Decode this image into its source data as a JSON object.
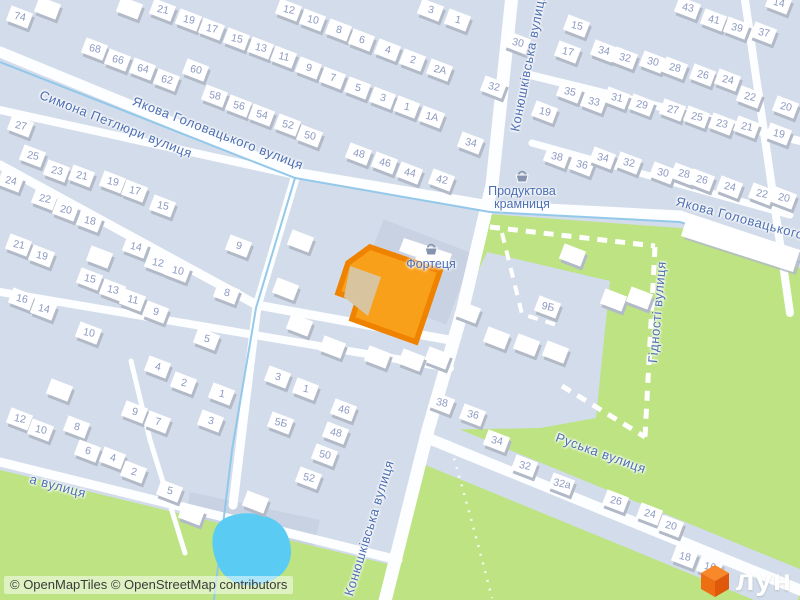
{
  "map": {
    "attribution": "© OpenMapTiles © OpenStreetMap contributors",
    "logo": {
      "text": "лун"
    },
    "colors": {
      "base": "#D3DCEA",
      "road": "#FDFEFF",
      "green": "#BDE383",
      "water": "#5ACBF3",
      "water_line": "#8EC6E9",
      "parcel": "#C9D2E2",
      "building": "#FFFFFF",
      "building_shadow": "#B2B9C7",
      "number": "#8C99C2",
      "label": "#4C6FB3",
      "selected_fill": "#F9A01B",
      "selected_stroke": "#EF8300",
      "selected_inner": "#D8C5A0",
      "logo_orange": "#F4700E",
      "attribution_text": "#3B3B3B"
    },
    "street_labels": [
      {
        "text": "Симона Петлюри вулиця",
        "x": 116,
        "y": 124,
        "rot": 21.5
      },
      {
        "text": "Якова Головацького вулиця",
        "x": 218,
        "y": 133,
        "rot": 21
      },
      {
        "text": "Якова Головацького",
        "x": 740,
        "y": 218,
        "rot": 15
      },
      {
        "text": "Конюшківська вулиця",
        "x": 528,
        "y": 62,
        "rot": -79
      },
      {
        "text": "Конюшківська вулиця",
        "x": 369,
        "y": 528,
        "rot": -73
      },
      {
        "text": "Руська вулиця",
        "x": 601,
        "y": 453,
        "rot": 20
      },
      {
        "text": "Гідності вулиця",
        "x": 657,
        "y": 312,
        "rot": -85
      },
      {
        "text": "а вулиця",
        "x": 58,
        "y": 486,
        "rot": 15
      }
    ],
    "pois": [
      {
        "lines": [
          "Продуктова",
          "крамниця"
        ],
        "x": 522,
        "y": 178,
        "icon": "shop-basket-icon"
      },
      {
        "lines": [
          "Фортеця"
        ],
        "x": 431,
        "y": 251,
        "icon": "shop-basket-icon"
      }
    ],
    "house_numbers": [
      [
        20,
        17,
        "74"
      ],
      [
        95,
        49,
        "68"
      ],
      [
        118,
        60,
        "66"
      ],
      [
        143,
        69,
        "64"
      ],
      [
        167,
        80,
        "62"
      ],
      [
        196,
        70,
        "60"
      ],
      [
        215,
        96,
        "58"
      ],
      [
        239,
        106,
        "56"
      ],
      [
        262,
        115,
        "54"
      ],
      [
        163,
        10,
        "21"
      ],
      [
        189,
        20,
        "19"
      ],
      [
        212,
        29,
        "17"
      ],
      [
        237,
        39,
        "15"
      ],
      [
        261,
        48,
        "13"
      ],
      [
        289,
        10,
        "12"
      ],
      [
        313,
        20,
        "10"
      ],
      [
        339,
        30,
        "8"
      ],
      [
        362,
        40,
        "6"
      ],
      [
        388,
        50,
        "4"
      ],
      [
        413,
        60,
        "2"
      ],
      [
        440,
        70,
        "2А"
      ],
      [
        431,
        10,
        "3"
      ],
      [
        458,
        20,
        "1"
      ],
      [
        518,
        43,
        "30"
      ],
      [
        494,
        87,
        "32"
      ],
      [
        284,
        57,
        "11"
      ],
      [
        309,
        68,
        "9"
      ],
      [
        333,
        78,
        "7"
      ],
      [
        358,
        88,
        "5"
      ],
      [
        383,
        98,
        "3"
      ],
      [
        407,
        107,
        "1"
      ],
      [
        432,
        117,
        "1А"
      ],
      [
        288,
        125,
        "52"
      ],
      [
        310,
        136,
        "50"
      ],
      [
        359,
        154,
        "48"
      ],
      [
        385,
        163,
        "46"
      ],
      [
        410,
        173,
        "44"
      ],
      [
        442,
        180,
        "42"
      ],
      [
        471,
        143,
        "34"
      ],
      [
        21,
        126,
        "27"
      ],
      [
        33,
        156,
        "25"
      ],
      [
        57,
        171,
        "23"
      ],
      [
        82,
        176,
        "21"
      ],
      [
        113,
        182,
        "19"
      ],
      [
        135,
        191,
        "17"
      ],
      [
        163,
        206,
        "15"
      ],
      [
        11,
        181,
        "24"
      ],
      [
        45,
        199,
        "22"
      ],
      [
        66,
        210,
        "20"
      ],
      [
        90,
        221,
        "18"
      ],
      [
        136,
        247,
        "14"
      ],
      [
        158,
        263,
        "12"
      ],
      [
        178,
        271,
        "10"
      ],
      [
        239,
        246,
        "9"
      ],
      [
        19,
        245,
        "21"
      ],
      [
        42,
        256,
        "19"
      ],
      [
        90,
        279,
        "15"
      ],
      [
        113,
        290,
        "13"
      ],
      [
        133,
        300,
        "11"
      ],
      [
        156,
        312,
        "9"
      ],
      [
        22,
        299,
        "16"
      ],
      [
        44,
        309,
        "14"
      ],
      [
        89,
        333,
        "10"
      ],
      [
        227,
        293,
        "8"
      ],
      [
        207,
        339,
        "5"
      ],
      [
        158,
        367,
        "4"
      ],
      [
        184,
        383,
        "2"
      ],
      [
        222,
        394,
        "1"
      ],
      [
        211,
        421,
        "3"
      ],
      [
        20,
        419,
        "12"
      ],
      [
        41,
        430,
        "10"
      ],
      [
        77,
        427,
        "8"
      ],
      [
        88,
        451,
        "6"
      ],
      [
        113,
        458,
        "4"
      ],
      [
        134,
        472,
        "2"
      ],
      [
        135,
        412,
        "9"
      ],
      [
        158,
        422,
        "7"
      ],
      [
        170,
        491,
        "5"
      ],
      [
        306,
        389,
        "1"
      ],
      [
        278,
        377,
        "3"
      ],
      [
        344,
        410,
        "46"
      ],
      [
        281,
        423,
        "5Б"
      ],
      [
        336,
        433,
        "48"
      ],
      [
        325,
        455,
        "50"
      ],
      [
        309,
        478,
        "52"
      ],
      [
        442,
        403,
        "38"
      ],
      [
        473,
        415,
        "36"
      ],
      [
        497,
        441,
        "34"
      ],
      [
        525,
        466,
        "32"
      ],
      [
        562,
        484,
        "32а"
      ],
      [
        616,
        501,
        "26"
      ],
      [
        650,
        514,
        "24"
      ],
      [
        671,
        526,
        "20"
      ],
      [
        685,
        557,
        "18"
      ],
      [
        710,
        567,
        "16"
      ],
      [
        548,
        307,
        "9Б"
      ],
      [
        688,
        8,
        "43"
      ],
      [
        714,
        20,
        "41"
      ],
      [
        737,
        28,
        "39"
      ],
      [
        764,
        33,
        "37"
      ],
      [
        779,
        3,
        "14"
      ],
      [
        577,
        26,
        "15"
      ],
      [
        568,
        52,
        "17"
      ],
      [
        604,
        51,
        "34"
      ],
      [
        625,
        58,
        "32"
      ],
      [
        653,
        62,
        "30"
      ],
      [
        675,
        68,
        "28"
      ],
      [
        703,
        75,
        "26"
      ],
      [
        728,
        80,
        "24"
      ],
      [
        750,
        97,
        "22"
      ],
      [
        786,
        107,
        "20"
      ],
      [
        570,
        92,
        "35"
      ],
      [
        594,
        102,
        "33"
      ],
      [
        617,
        98,
        "31"
      ],
      [
        642,
        105,
        "29"
      ],
      [
        673,
        110,
        "27"
      ],
      [
        697,
        117,
        "25"
      ],
      [
        722,
        124,
        "23"
      ],
      [
        747,
        127,
        "21"
      ],
      [
        779,
        134,
        "19"
      ],
      [
        545,
        112,
        "19"
      ],
      [
        557,
        157,
        "38"
      ],
      [
        582,
        165,
        "36"
      ],
      [
        603,
        158,
        "34"
      ],
      [
        629,
        163,
        "32"
      ],
      [
        663,
        173,
        "30"
      ],
      [
        684,
        174,
        "28"
      ],
      [
        702,
        180,
        "26"
      ],
      [
        730,
        187,
        "24"
      ],
      [
        762,
        194,
        "22"
      ],
      [
        784,
        198,
        "20"
      ]
    ],
    "unlabeled_buildings": [
      [
        301,
        241
      ],
      [
        286,
        289
      ],
      [
        333,
        347
      ],
      [
        378,
        357
      ],
      [
        300,
        325
      ],
      [
        48,
        8
      ],
      [
        130,
        8
      ],
      [
        60,
        390
      ],
      [
        468,
        312
      ],
      [
        497,
        338
      ],
      [
        527,
        345
      ],
      [
        556,
        352
      ],
      [
        614,
        300
      ],
      [
        573,
        255
      ],
      [
        640,
        298
      ],
      [
        256,
        502
      ],
      [
        192,
        514
      ],
      [
        100,
        257
      ],
      [
        438,
        358
      ],
      [
        412,
        360
      ]
    ]
  }
}
